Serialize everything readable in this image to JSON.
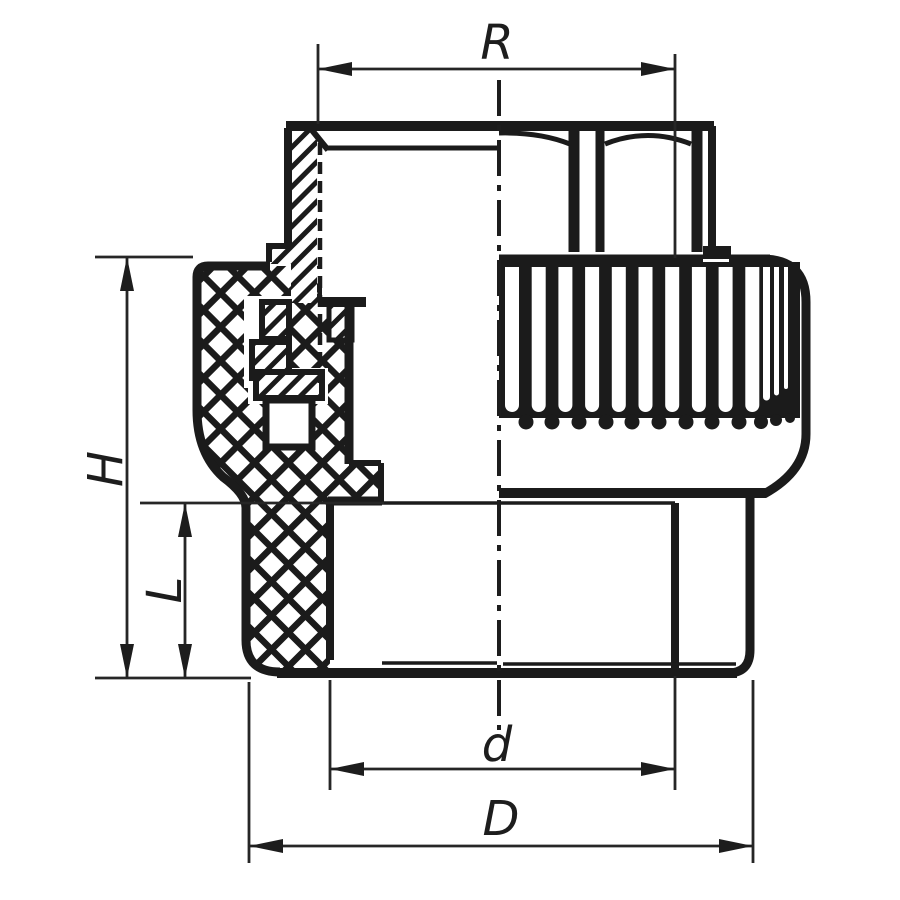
{
  "figure": {
    "kind": "technical-drawing",
    "colors": {
      "outline": "#1b1b1b",
      "dimension_lines": "#262626",
      "background": "#ffffff"
    },
    "dimensions": {
      "thread_size": "R",
      "overall_height": "H",
      "socket_depth": "L",
      "inner_diameter": "d",
      "outer_diameter": "D"
    }
  }
}
